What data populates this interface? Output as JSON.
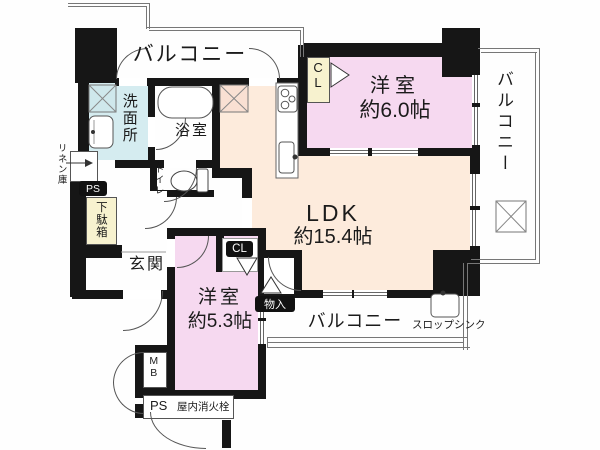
{
  "colors": {
    "wall": "#161616",
    "bedroom_fill": "#f6d9f0",
    "ldk_fill": "#fdebdc",
    "washroom_fill": "#d5ecf0",
    "cabinet_fill": "#f7f2cf",
    "outline_gray": "#777777",
    "badge_bg": "#111111",
    "badge_text": "#ffffff"
  },
  "labels": {
    "balcony_top": "バルコニー",
    "balcony_right": "バルコニー",
    "balcony_bottom": "バルコニー",
    "washroom": "洗面所",
    "bathroom": "浴室",
    "toilet": "トイレ",
    "linen_closet": "リネン庫",
    "ps_upper": "PS",
    "shoe_cabinet": "下駄箱",
    "entrance": "玄関",
    "closet_upper": "CL",
    "closet_lower": "CL",
    "storage": "物入",
    "meter_box": "MB",
    "ps_lower": "PS",
    "fire_hydrant": "屋内消火栓",
    "slop_sink": "スロップシンク"
  },
  "rooms": {
    "ldk": {
      "name": "LDK",
      "area": "約15.4帖"
    },
    "bedroom_large": {
      "name": "洋室",
      "area": "約6.0帖"
    },
    "bedroom_small": {
      "name": "洋室",
      "area": "約5.3帖"
    }
  },
  "icons": {
    "bathtub-icon": "rounded rectangle tub",
    "toilet-icon": "bowl with tank",
    "washing-machine-icon": "crossed square",
    "refrigerator-icon": "crossed square",
    "escape-hatch-icon": "crossed square",
    "stove-icon": "three burner circles",
    "kitchen-sink-icon": "basin with faucet",
    "vanity-sink-icon": "basin with faucet",
    "slop-sink-icon": "basin with faucet",
    "door-swing-icon": "quarter arc",
    "folding-door-icon": "triangle",
    "linen-arrow-icon": "right arrow",
    "window-icon": "double line opening",
    "railing-icon": "double line balcony rail"
  }
}
